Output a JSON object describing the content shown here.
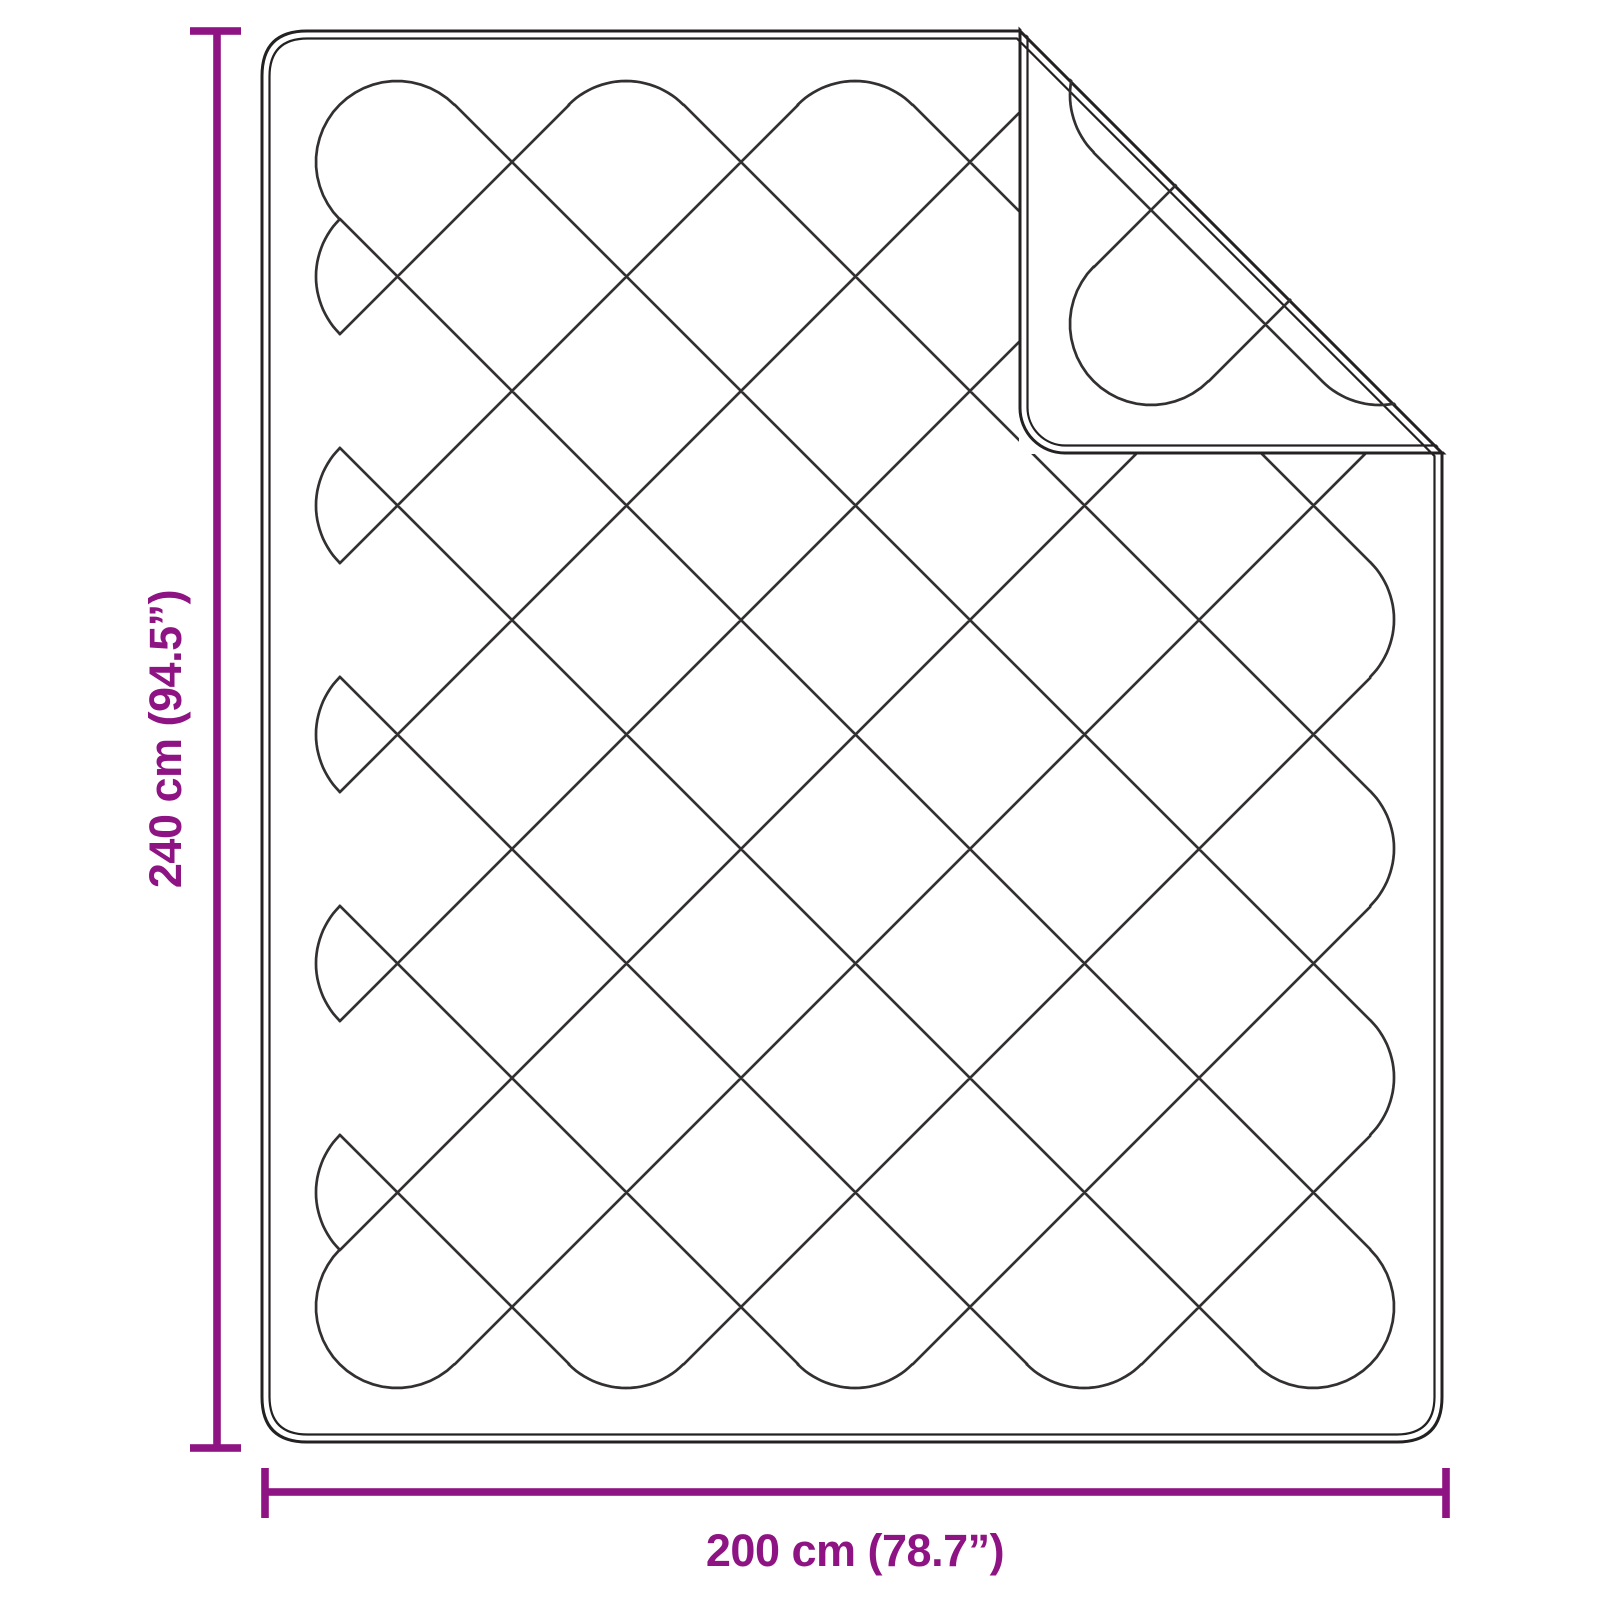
{
  "diagram": {
    "height_label": "240 cm (94.5”)",
    "width_label": "200 cm (78.7”)",
    "dimensions": {
      "height_cm": "240",
      "height_inches": "94.5",
      "width_cm": "200",
      "width_inches": "78.7"
    },
    "colors": {
      "accent": "#8E1484",
      "outline": "#242122",
      "quilt_line": "#333031",
      "background": "#FFFFFF"
    }
  }
}
